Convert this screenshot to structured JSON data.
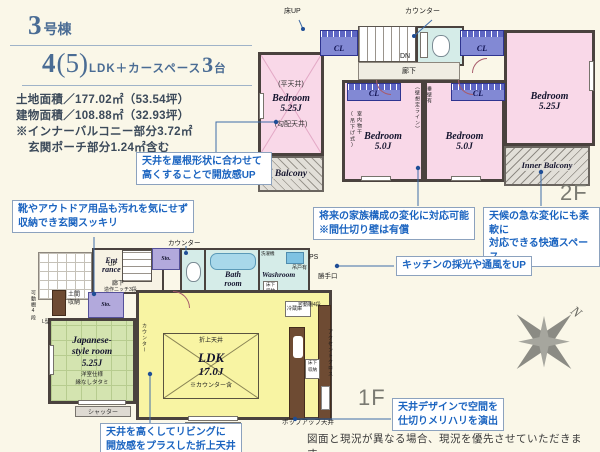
{
  "header": {
    "building_num": "3",
    "building_suffix": "号棟",
    "plan_num1": "4",
    "plan_paren": "(5)",
    "plan_mid": "LDK＋カースペース",
    "plan_num2": "3",
    "plan_suffix": "台",
    "land_area": "土地面積／177.02㎡（53.54坪）",
    "building_area": "建物面積／108.88㎡（32.93坪）",
    "note1": "※インナーバルコニー部分3.72㎡",
    "note2": "玄関ポーチ部分1.24㎡含む"
  },
  "callouts": {
    "roof": "天井を屋根形状に合わせて\n高くすることで開放感UP",
    "shoes": "靴やアウトドア用品も汚れを気にせず\n収納でき玄関スッキリ",
    "partition": "将来の家族構成の変化に対応可能\n※間仕切り壁は有償",
    "weather": "天候の急な変化にも柔軟に\n対応できる快適スペース",
    "kitchen": "キッチンの採光や通風をUP",
    "coffered": "天井を高くしてリビングに\n開放感をプラスした折上天井",
    "ceiling_design": "天井デザインで空間を\n仕切りメリハリを演出"
  },
  "floor2": {
    "label": "2F",
    "yuka_up": "床UP",
    "counter": "カウンター",
    "dn": "DN",
    "hallway": "廊下",
    "cl": "CL",
    "flat_ceiling": "(平天井)",
    "sloped_ceiling": "(勾配天井)",
    "indoor_drying": "室内物干\n(吊下げ式)",
    "tare_wall": "垂壁有",
    "wall_line": "（壁想定ライン）",
    "bedroom_a": {
      "name": "Bedroom",
      "size": "5.25J"
    },
    "bedroom_b": {
      "name": "Bedroom",
      "size": "5.0J"
    },
    "bedroom_c": {
      "name": "Bedroom",
      "size": "5.0J"
    },
    "bedroom_d": {
      "name": "Bedroom",
      "size": "5.25J"
    },
    "balcony": "Balcony",
    "inner_balcony": "Inner Balcony"
  },
  "floor1": {
    "label": "1F",
    "counter_top": "カウンター",
    "entrance": "Ent\nrance",
    "up": "UP",
    "hallway": "廊下",
    "niche": "造作ニッチ3段",
    "sto": "Sto.",
    "bath": "Bath\nroom",
    "washroom": "Washroom",
    "washer": "洗濯機",
    "hanging": "吊戸有",
    "underfloor": "床下\n収納",
    "ps": "PS",
    "backdoor": "勝手口",
    "shelf4": "可動棚4段",
    "l_type": "L型",
    "doma": "土間\n収納",
    "jp_l1": "Japanese-",
    "jp_l2": "style room",
    "jp_size": "5.25J",
    "jp_note1": "洋室仕様",
    "jp_note2": "縁なしタタミ",
    "counter_v": "カウンター",
    "oriage": "折上天井",
    "ldk": "LDK",
    "ldk_size": "17.0J",
    "ldk_note": "※カウンター含",
    "fridge": "冷蔵庫",
    "accent": "アクセントクロス",
    "shutter": "シャッター",
    "popup": "ポップアップ天井"
  },
  "footer": "図面と現況が異なる場合、現況を優先させていただきます。",
  "compass_n": "N",
  "colors": {
    "accent_blue": "#1B64C0",
    "room_pink": "#F9D8E8",
    "room_yellow": "#F8F4A3",
    "room_green": "#D4E4B0",
    "closet_blue": "#8289D4",
    "background": "#FAF7E8"
  }
}
